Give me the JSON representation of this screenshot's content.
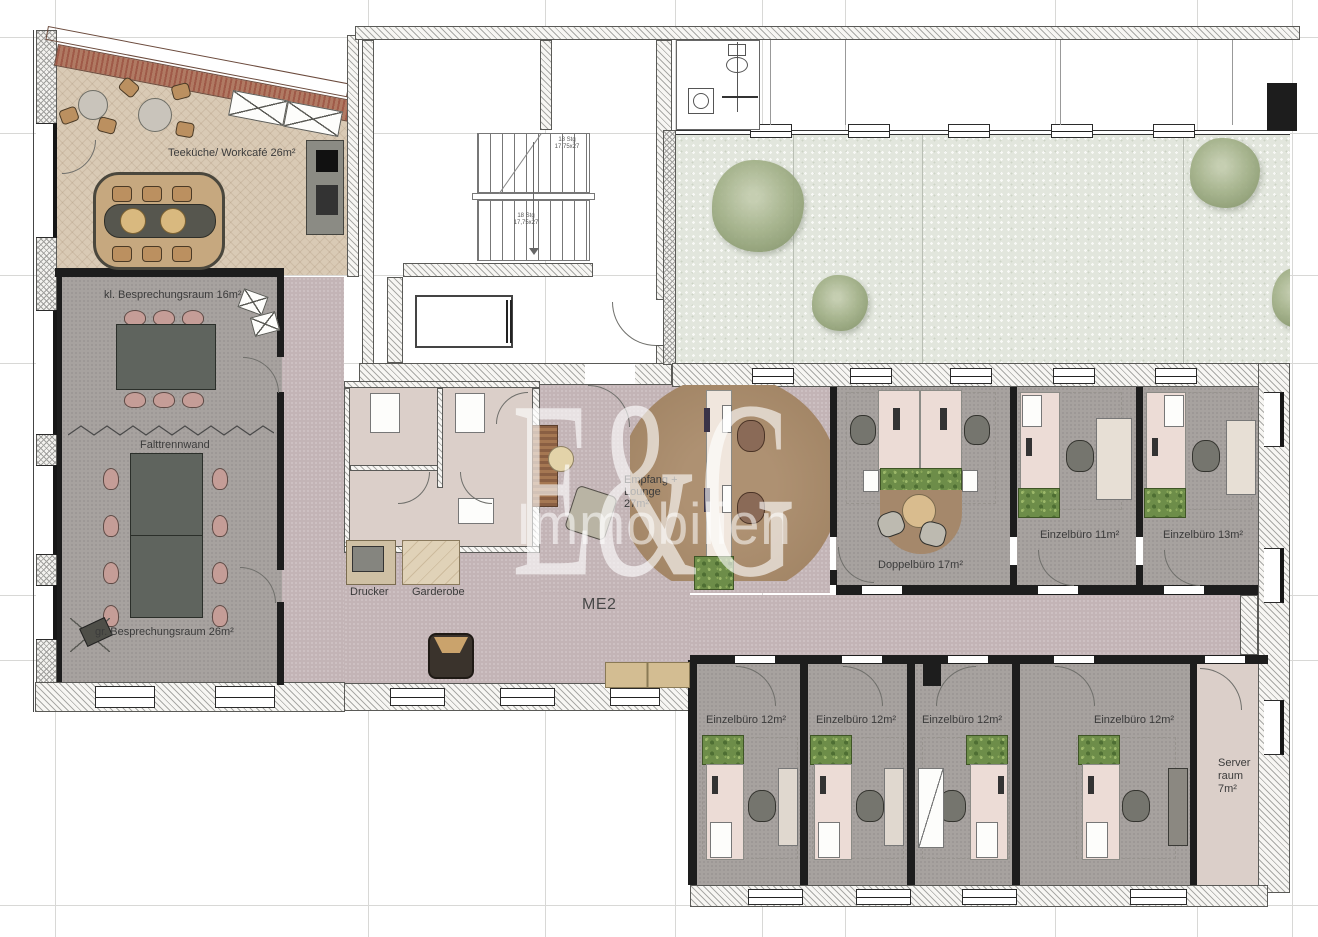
{
  "watermark": {
    "logo": "E&G",
    "name": "Immobilien"
  },
  "rooms": {
    "teekueche": {
      "label": "Teeküche/ Workcafé 26m²"
    },
    "kl_besprechungsraum": {
      "label": "kl. Besprechungsraum 16m²"
    },
    "falttrennwand": {
      "label": "Falttrennwand"
    },
    "gr_besprechungsraum": {
      "label": "gr. Besprechungsraum 26m²"
    },
    "drucker": {
      "label": "Drucker"
    },
    "garderobe": {
      "label": "Garderobe"
    },
    "empfang": {
      "line1": "Empfang +",
      "line2": "Lounge",
      "line3": "27m²"
    },
    "corridor_me2": {
      "label": "ME2"
    },
    "doppelbuero": {
      "label": "Doppelbüro 17m²"
    },
    "einzelbuero_11": {
      "label": "Einzelbüro 11m²"
    },
    "einzelbuero_13": {
      "label": "Einzelbüro 13m²"
    },
    "einzelbuero_12_1": {
      "label": "Einzelbüro 12m²"
    },
    "einzelbuero_12_2": {
      "label": "Einzelbüro 12m²"
    },
    "einzelbuero_12_3": {
      "label": "Einzelbüro 12m²"
    },
    "einzelbuero_12_4": {
      "label": "Einzelbüro 12m²"
    },
    "serverraum": {
      "line1": "Server",
      "line2": "raum",
      "line3": "7m²"
    }
  },
  "stairs": {
    "upper": {
      "line1": "18 Stg",
      "line2": "17,75x27"
    },
    "lower": {
      "line1": "18 Stg",
      "line2": "17,75x27"
    }
  },
  "colors": {
    "corridor_floor": "#c3b4b6",
    "office_floor": "#a7a29f",
    "kitchen_floor": "#d9cab5",
    "small_room_floor": "#dbcfc9",
    "courtyard": "#e2e6dd",
    "reception_rug": "#a68a6c",
    "desk": "#ecdcd6",
    "meeting_table": "#5f645e",
    "chair_pink": "#c59d97",
    "plant_green": "#6d8d49",
    "wall_black": "#1d1d1d"
  }
}
